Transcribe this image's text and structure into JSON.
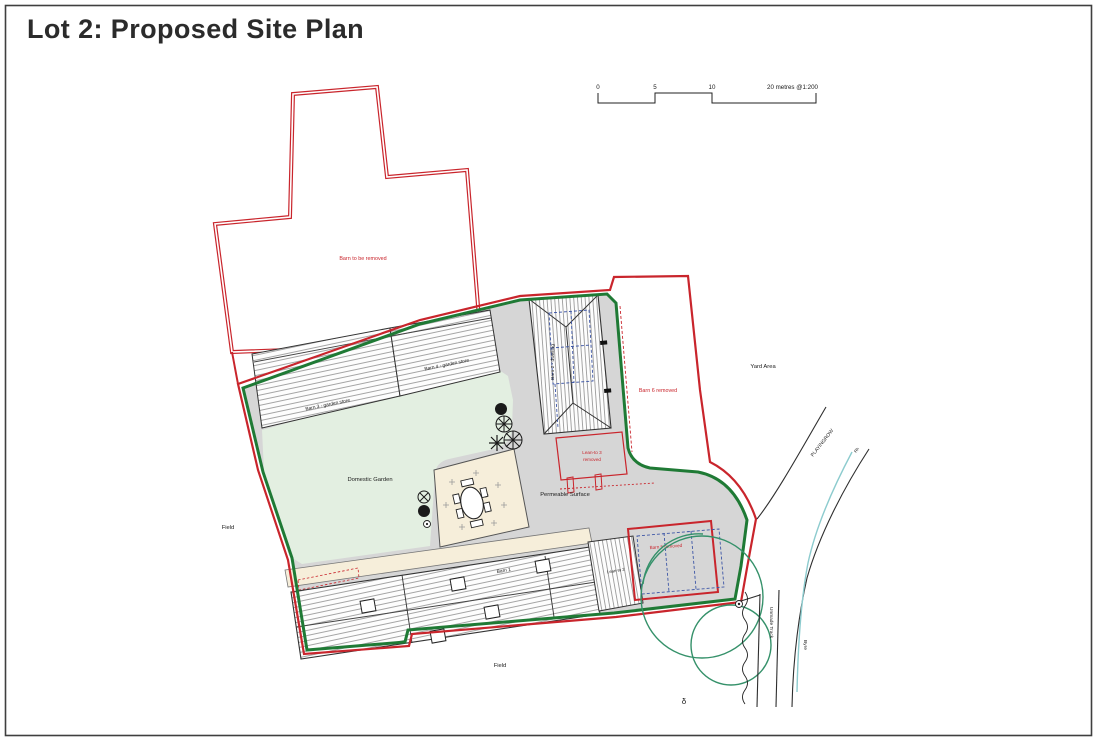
{
  "page": {
    "title": "Lot 2: Proposed Site Plan"
  },
  "scale_bar": {
    "tick0": "0",
    "tick5": "5",
    "tick10": "10",
    "caption": "20 metres @1:200"
  },
  "plan": {
    "barn_removed_label": "Barn to be removed",
    "barn3_label": "Barn 3 - garden store",
    "barn4_label": "Barn 4 - garden store",
    "barn2_label": "Barn 2 - dwelling",
    "barn6_label": "Barn 6 removed",
    "leanto3_line1": "Lean-to 3",
    "leanto3_line2": "removed",
    "yard_label": "Yard Area",
    "garden_label": "Domestic Garden",
    "permeable_label": "Permeable Surface",
    "barn1_label": "Barn 1",
    "leanto2_label": "Lean-to 2",
    "barn5_label": "Barn 5 removed",
    "field_left_label": "Field",
    "field_bottom_label": "Field",
    "road_label": "PLAYINGROW",
    "road_small_label": "Rh",
    "track_label": "Unmade Track",
    "byre_label": "Byre",
    "marker_glyph": "δ"
  },
  "colors": {
    "boundary_red": "#c9252c",
    "hedge_green": "#1f7a35",
    "garden_green": "#e3efe1",
    "yard_grey": "#d6d6d6",
    "patio_cream": "#f6eeda",
    "proposal_blue": "#3d56a6",
    "stream_teal": "#8ccbce",
    "tree_green": "#35916a"
  }
}
